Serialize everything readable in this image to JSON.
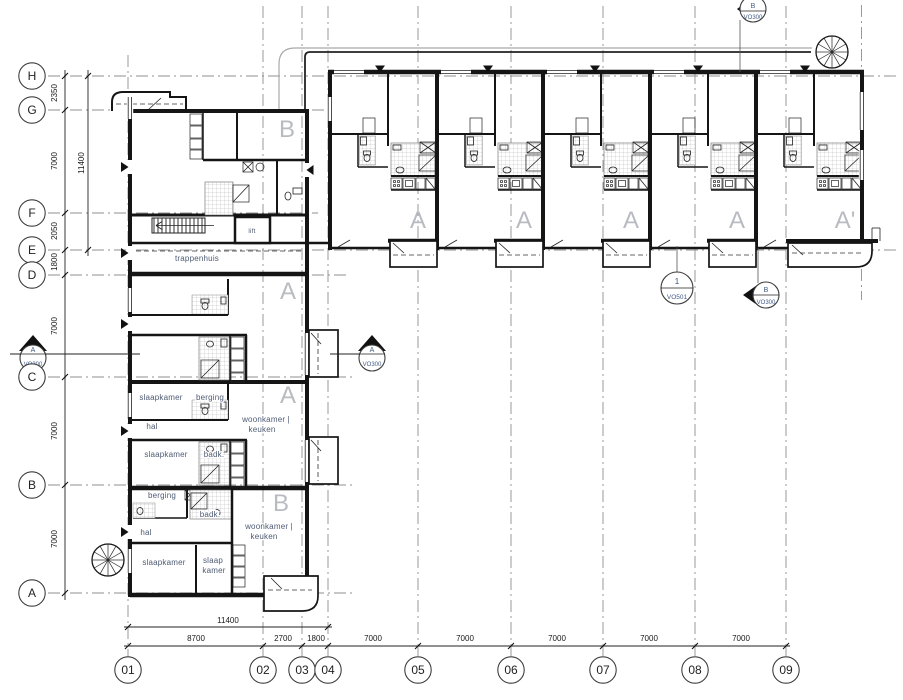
{
  "grid": {
    "rows": [
      {
        "label": "H"
      },
      {
        "label": "G"
      },
      {
        "label": "F"
      },
      {
        "label": "E"
      },
      {
        "label": "D"
      },
      {
        "label": "C"
      },
      {
        "label": "B"
      },
      {
        "label": "A"
      }
    ],
    "cols": [
      {
        "label": "01"
      },
      {
        "label": "02"
      },
      {
        "label": "03"
      },
      {
        "label": "04"
      },
      {
        "label": "05"
      },
      {
        "label": "06"
      },
      {
        "label": "07"
      },
      {
        "label": "08"
      },
      {
        "label": "09"
      }
    ]
  },
  "dimensions": {
    "left": [
      {
        "value": "2350"
      },
      {
        "value": "7000"
      },
      {
        "value": "2050"
      },
      {
        "value": "1800"
      },
      {
        "value": "7000"
      },
      {
        "value": "7000"
      },
      {
        "value": "7000"
      }
    ],
    "left_total": {
      "value": "11400"
    },
    "bottom_total": {
      "value": "11400"
    },
    "bottom": [
      {
        "value": "8700"
      },
      {
        "value": "2700"
      },
      {
        "value": "1800"
      },
      {
        "value": "7000"
      },
      {
        "value": "7000"
      },
      {
        "value": "7000"
      },
      {
        "value": "7000"
      },
      {
        "value": "7000"
      }
    ]
  },
  "units": {
    "top_wing": [
      {
        "label": "A"
      },
      {
        "label": "A"
      },
      {
        "label": "A"
      },
      {
        "label": "A"
      },
      {
        "label": "A'"
      }
    ],
    "left_wing": [
      {
        "label": "B"
      },
      {
        "label": "A"
      },
      {
        "label": "A"
      },
      {
        "label": "B"
      }
    ]
  },
  "rooms": {
    "trappenhuis": {
      "label": "trappenhuis"
    },
    "lift": {
      "label": "lift"
    },
    "apartment_a": {
      "slaapkamer_1": "slaapkamer",
      "berging": "berging",
      "hal": "hal",
      "slaapkamer_2": "slaapkamer",
      "badkamer": "badk.",
      "woonkamer_line1": "woonkamer |",
      "woonkamer_line2": "keuken"
    },
    "apartment_b": {
      "berging": "berging",
      "hal": "hal",
      "slaapkamer_1": "slaapkamer",
      "slaapkamer_2_line1": "slaap",
      "slaapkamer_2_line2": "kamer",
      "badkamer": "badk.",
      "woonkamer_line1": "woonkamer |",
      "woonkamer_line2": "keuken"
    }
  },
  "markers": {
    "section_top": {
      "ref": "B",
      "sheet": "VO300"
    },
    "section_left": {
      "ref": "A",
      "sheet": "VO300"
    },
    "section_mid": {
      "ref": "A",
      "sheet": "VO300"
    },
    "detail": {
      "ref": "1",
      "sheet": "VO501"
    },
    "section_right": {
      "ref": "B",
      "sheet": "VO300"
    }
  },
  "colors": {
    "wall": "#151515",
    "grid": "#8f8f8f",
    "unit_label": "#b8bbc1",
    "room_label": "#4e5b73",
    "marker_label": "#3f5b86"
  }
}
